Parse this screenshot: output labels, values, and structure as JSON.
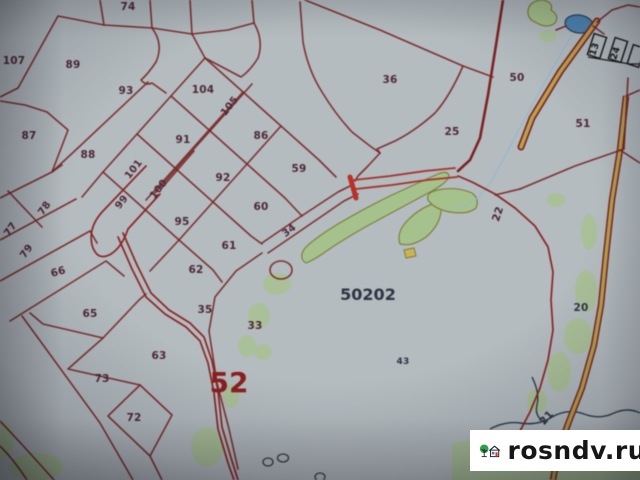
{
  "map": {
    "bg": "#b4bcc0",
    "boundary_color": "#7a2626",
    "road_color": "#b03028",
    "road_fill": "#b9a252",
    "green": "#a6c289",
    "green_outline": "#7d7d35",
    "pond_fill": "#4f86b4",
    "stream_color": "#93b8cc",
    "dark_stream_color": "#2c3c4a",
    "label_color": "#4f2936",
    "alt_label_color": "#2f3442",
    "marker_label_color": "#16161a",
    "quarter_label": {
      "text": "52",
      "x": 229,
      "y": 392,
      "size": 28
    },
    "zone_label": {
      "text": "50202",
      "x": 368,
      "y": 300,
      "size": 16
    },
    "parcel_labels": [
      {
        "t": "74",
        "x": 128,
        "y": 10
      },
      {
        "t": "107",
        "x": 14,
        "y": 64
      },
      {
        "t": "89",
        "x": 73,
        "y": 68
      },
      {
        "t": "93",
        "x": 126,
        "y": 94
      },
      {
        "t": "104",
        "x": 203,
        "y": 93
      },
      {
        "t": "105",
        "x": 232,
        "y": 108,
        "r": -52,
        "s": 10
      },
      {
        "t": "86",
        "x": 261,
        "y": 139
      },
      {
        "t": "87",
        "x": 29,
        "y": 139
      },
      {
        "t": "88",
        "x": 88,
        "y": 158
      },
      {
        "t": "91",
        "x": 183,
        "y": 143
      },
      {
        "t": "59",
        "x": 299,
        "y": 172
      },
      {
        "t": "92",
        "x": 223,
        "y": 181
      },
      {
        "t": "101",
        "x": 136,
        "y": 171,
        "r": -52,
        "s": 10
      },
      {
        "t": "100",
        "x": 161,
        "y": 191,
        "r": -52,
        "s": 10
      },
      {
        "t": "99",
        "x": 124,
        "y": 204,
        "r": -52,
        "s": 10
      },
      {
        "t": "95",
        "x": 182,
        "y": 225
      },
      {
        "t": "60",
        "x": 261,
        "y": 210
      },
      {
        "t": "34",
        "x": 291,
        "y": 233,
        "r": -38,
        "s": 10
      },
      {
        "t": "61",
        "x": 229,
        "y": 249
      },
      {
        "t": "62",
        "x": 196,
        "y": 273
      },
      {
        "t": "77",
        "x": 13,
        "y": 231,
        "r": -55,
        "s": 10
      },
      {
        "t": "78",
        "x": 47,
        "y": 210,
        "r": -55,
        "s": 10
      },
      {
        "t": "79",
        "x": 29,
        "y": 253,
        "r": -55,
        "s": 10
      },
      {
        "t": "66",
        "x": 59,
        "y": 275,
        "r": -15
      },
      {
        "t": "65",
        "x": 90,
        "y": 317
      },
      {
        "t": "35",
        "x": 205,
        "y": 313
      },
      {
        "t": "63",
        "x": 159,
        "y": 359
      },
      {
        "t": "73",
        "x": 102,
        "y": 382
      },
      {
        "t": "72",
        "x": 134,
        "y": 421
      },
      {
        "t": "33",
        "x": 255,
        "y": 329
      },
      {
        "t": "36",
        "x": 390,
        "y": 83
      },
      {
        "t": "25",
        "x": 452,
        "y": 135
      },
      {
        "t": "50",
        "x": 517,
        "y": 81
      },
      {
        "t": "51",
        "x": 583,
        "y": 127
      },
      {
        "t": "22",
        "x": 501,
        "y": 215,
        "r": -72
      },
      {
        "t": "20",
        "x": 581,
        "y": 311,
        "c": "alt"
      },
      {
        "t": "21",
        "x": 549,
        "y": 420,
        "r": -48,
        "c": "alt"
      },
      {
        "t": "43",
        "x": 403,
        "y": 364,
        "s": 9,
        "c": "alt"
      }
    ],
    "marker_labels": [
      {
        "t": "13",
        "x": 597,
        "y": 50,
        "r": -72,
        "s": 9,
        "c": "black"
      },
      {
        "t": "24",
        "x": 618,
        "y": 54,
        "r": -72,
        "s": 9,
        "c": "black"
      }
    ]
  },
  "watermark": {
    "site": "rosndv.ru"
  }
}
